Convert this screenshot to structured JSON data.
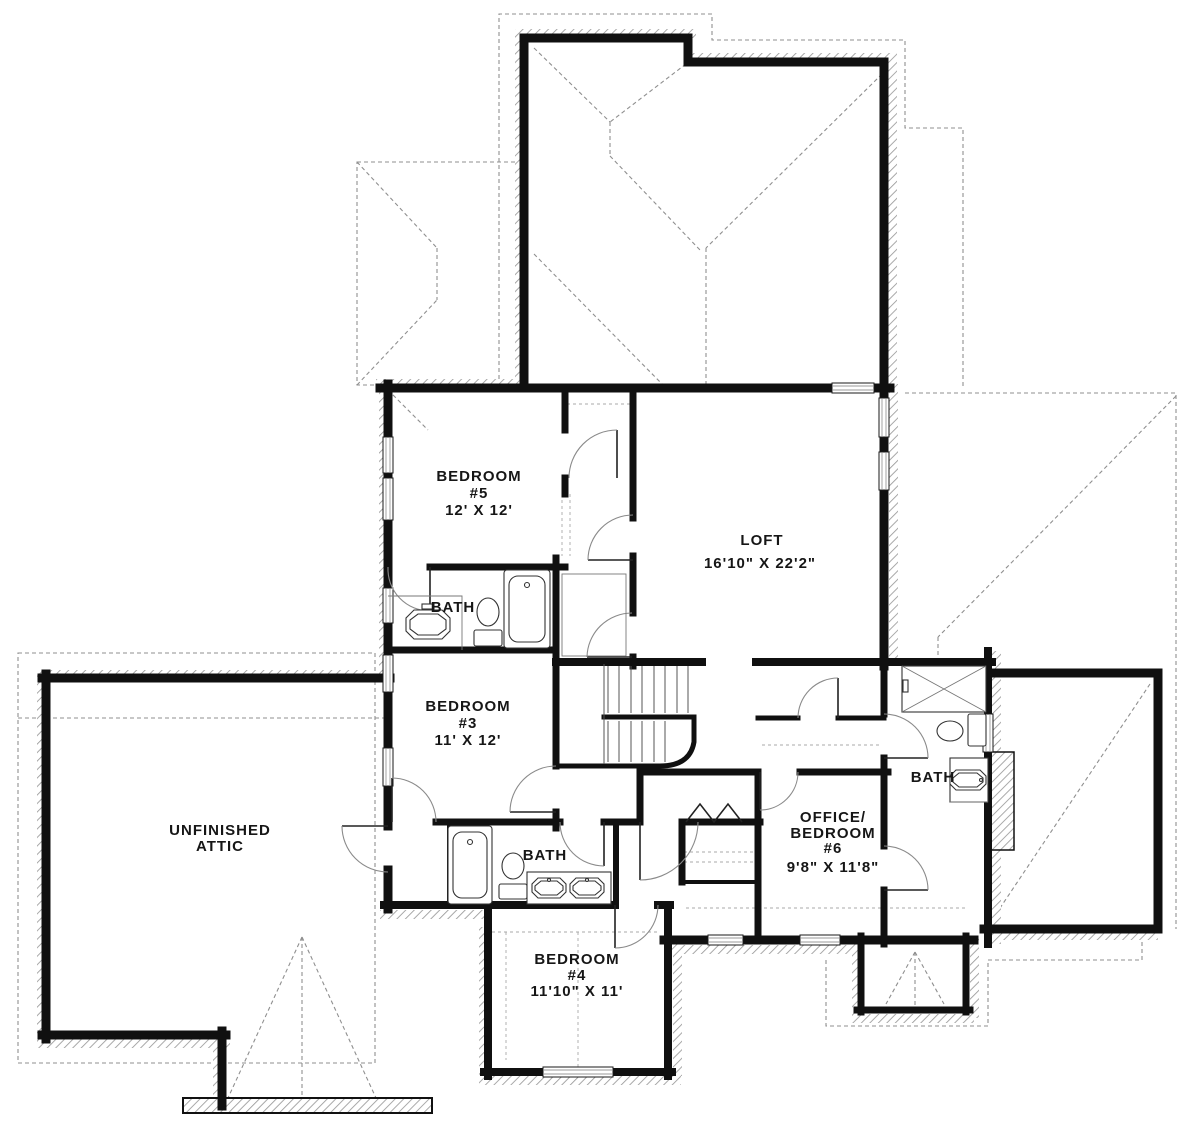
{
  "plan": {
    "title": "Second floor plan",
    "colors": {
      "wall": "#101010",
      "roof_dashed": "#8f8f8f",
      "hatch": "#9a9a9a",
      "label_text": "#161616",
      "background": "#ffffff"
    },
    "rooms": {
      "bedroom5": {
        "name_line1": "BEDROOM",
        "name_line2": "#5",
        "dims": "12' X 12'"
      },
      "loft": {
        "name_line1": "LOFT",
        "dims": "16'10\" X 22'2\""
      },
      "bath_upper": {
        "name_line1": "BATH"
      },
      "bedroom3": {
        "name_line1": "BEDROOM",
        "name_line2": "#3",
        "dims": "11' X 12'"
      },
      "unfinished_attic": {
        "name_line1": "UNFINISHED",
        "name_line2": "ATTIC"
      },
      "bath_lower": {
        "name_line1": "BATH"
      },
      "bedroom4": {
        "name_line1": "BEDROOM",
        "name_line2": "#4",
        "dims": "11'10\" X 11'"
      },
      "office_bedroom6": {
        "name_line1": "OFFICE/",
        "name_line2": "BEDROOM",
        "name_line3": "#6",
        "dims": "9'8\" X 11'8\""
      },
      "bath_right": {
        "name_line1": "BATH"
      }
    }
  }
}
